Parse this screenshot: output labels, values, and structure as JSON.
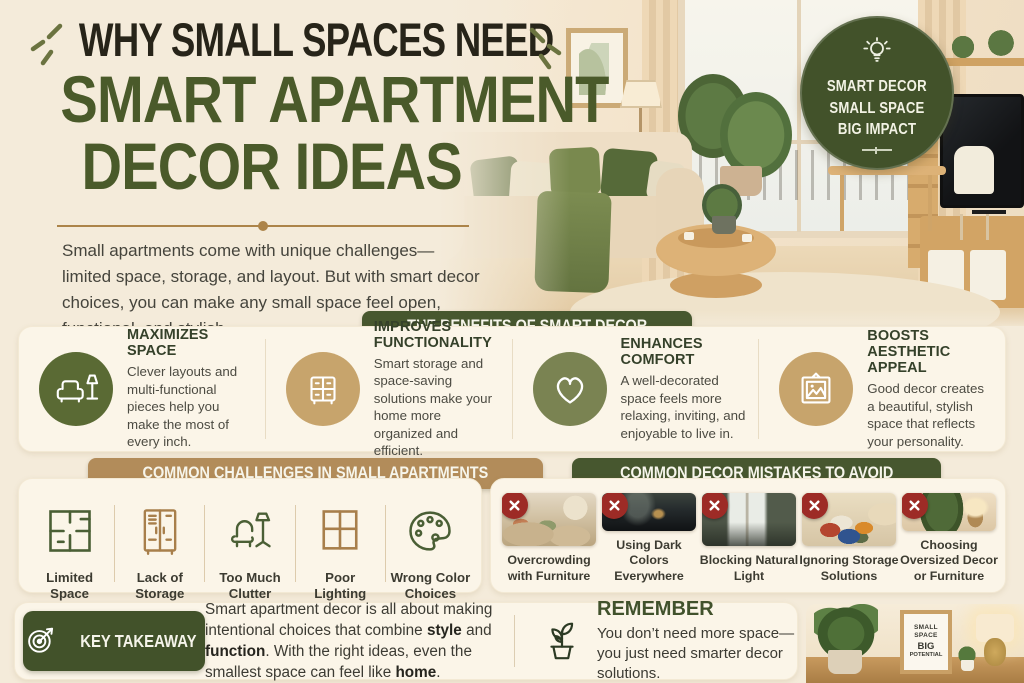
{
  "colors": {
    "accent_green": "#47572f",
    "accent_tan": "#b28c5a",
    "badge_green": "#42522a",
    "circle_green": "#5a6a34",
    "circle_olive": "#7a8352",
    "circle_tan": "#c7a46c",
    "error_red": "#9d2b26",
    "gold_divider": "#ac8449"
  },
  "header": {
    "title_line1": "WHY SMALL SPACES NEED",
    "title_line2": "SMART APARTMENT",
    "title_line3": "DECOR IDEAS",
    "intro": "Small apartments come with unique challenges—limited space, storage, and layout. But with smart decor choices, you can make any small space feel open, functional, and stylish."
  },
  "hero_badge": {
    "icon": "lightbulb-icon",
    "line1": "SMART DECOR",
    "line2": "SMALL SPACE",
    "line3": "BIG IMPACT"
  },
  "benefits": {
    "header": "THE BENEFITS OF SMART DECOR",
    "items": [
      {
        "icon": "sofa-lamp-icon",
        "title": "MAXIMIZES SPACE",
        "text": "Clever layouts and multi-functional pieces help you make the most of every inch."
      },
      {
        "icon": "dresser-icon",
        "title": "IMPROVES FUNCTIONALITY",
        "text": "Smart storage and space-saving solutions make your home more organized and efficient."
      },
      {
        "icon": "heart-icon",
        "title": "ENHANCES COMFORT",
        "text": "A well-decorated space feels more relaxing, inviting, and enjoyable to live in."
      },
      {
        "icon": "picture-frame-icon",
        "title": "BOOSTS AESTHETIC APPEAL",
        "text": "Good decor creates a beautiful, stylish space that reflects your personality."
      }
    ]
  },
  "challenges": {
    "header": "COMMON CHALLENGES IN SMALL APARTMENTS",
    "items": [
      {
        "icon": "floor-plan-icon",
        "label": "Limited Space"
      },
      {
        "icon": "wardrobe-icon",
        "label": "Lack of Storage"
      },
      {
        "icon": "armchair-lamp-icon",
        "label": "Too Much Clutter"
      },
      {
        "icon": "window-icon",
        "label": "Poor Lighting"
      },
      {
        "icon": "paint-palette-icon",
        "label": "Wrong Color Choices"
      }
    ]
  },
  "mistakes": {
    "header": "COMMON DECOR MISTAKES TO AVOID",
    "items": [
      {
        "photo": "overcrowded-living-room",
        "label": "Overcrowding with Furniture"
      },
      {
        "photo": "dark-colored-room",
        "label": "Using Dark Colors Everywhere"
      },
      {
        "photo": "blocked-window",
        "label": "Blocking Natural Light"
      },
      {
        "photo": "cluttered-storage-pile",
        "label": "Ignoring Storage Solutions"
      },
      {
        "photo": "oversized-plant-lamp",
        "label": "Choosing Oversized Decor or Furniture"
      }
    ]
  },
  "takeaway": {
    "badge_label": "KEY TAKEAWAY",
    "icon": "target-arrow-icon",
    "segments": [
      {
        "t": "Smart apartment decor is all about making intentional choices that combine "
      },
      {
        "t": "style",
        "b": true
      },
      {
        "t": " and "
      },
      {
        "t": "function",
        "b": true
      },
      {
        "t": ". With the right ideas, even the smallest space can feel like "
      },
      {
        "t": "home",
        "b": true
      },
      {
        "t": "."
      }
    ]
  },
  "remember": {
    "icon": "potted-plant-icon",
    "title": "REMEMBER",
    "text": "You don’t need more space—you just need smarter decor solutions."
  },
  "bottom_photo": {
    "sign_line1": "SMALL",
    "sign_line2": "SPACE",
    "sign_line3": "BIG",
    "sign_line4": "POTENTIAL"
  }
}
